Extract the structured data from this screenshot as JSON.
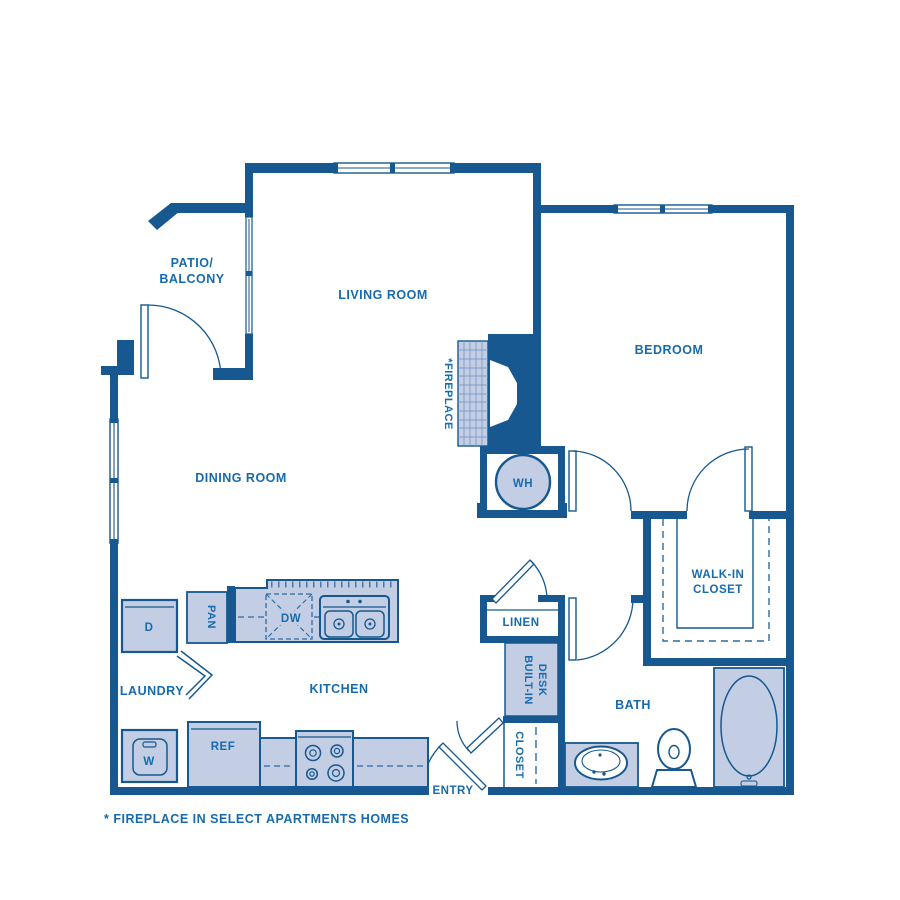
{
  "colors": {
    "wall_blue": "#16588F",
    "label_blue": "#176BAD",
    "fixture_fill": "#C3CDE3",
    "background": "#FFFFFF"
  },
  "plan": {
    "room_labels": {
      "patio_1": "PATIO/",
      "patio_2": "BALCONY",
      "living": "LIVING ROOM",
      "dining": "DINING ROOM",
      "bedroom": "BEDROOM",
      "kitchen": "KITCHEN",
      "laundry": "LAUNDRY",
      "bath": "BATH",
      "entry": "ENTRY",
      "linen": "LINEN",
      "entry_closet": "CLOSET",
      "walkin_1": "WALK-IN",
      "walkin_2": "CLOSET",
      "desk_1": "BUILT-IN",
      "desk_2": "DESK",
      "fireplace": "*FIREPLACE"
    },
    "appliance_labels": {
      "dryer": "D",
      "washer": "W",
      "pantry": "PAN",
      "dishwasher": "DW",
      "refrigerator": "REF",
      "water_heater": "WH"
    },
    "footnote": "* FIREPLACE IN SELECT APARTMENTS HOMES"
  }
}
